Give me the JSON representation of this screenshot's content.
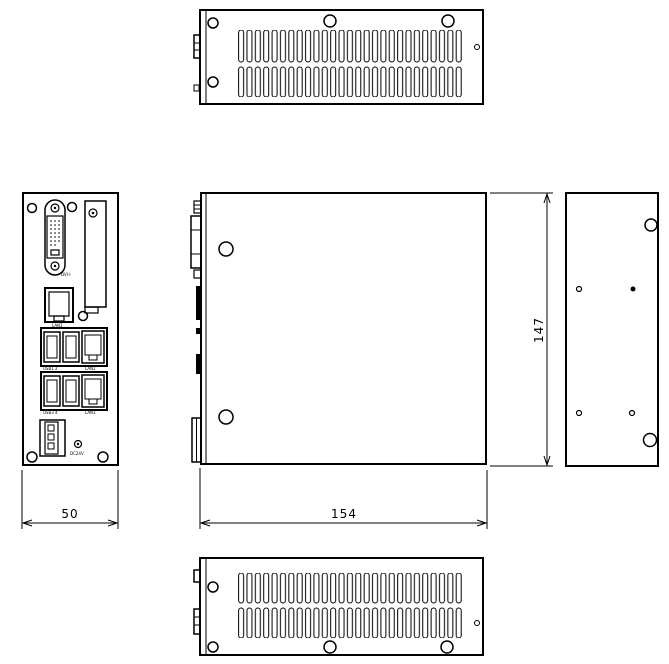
{
  "drawing": {
    "colors": {
      "line": "#000000",
      "background": "#ffffff"
    },
    "dimensions": {
      "front_width_mm": "50",
      "depth_mm": "154",
      "height_mm": "147"
    },
    "front_panel_labels": {
      "dvi": "DVI-I",
      "lan1": "LAN1",
      "usb_top": "USB1 2",
      "lan2": "LAN2",
      "usb_bottom": "USB3 4",
      "lan3": "LAN3",
      "power": "DC24V"
    }
  }
}
